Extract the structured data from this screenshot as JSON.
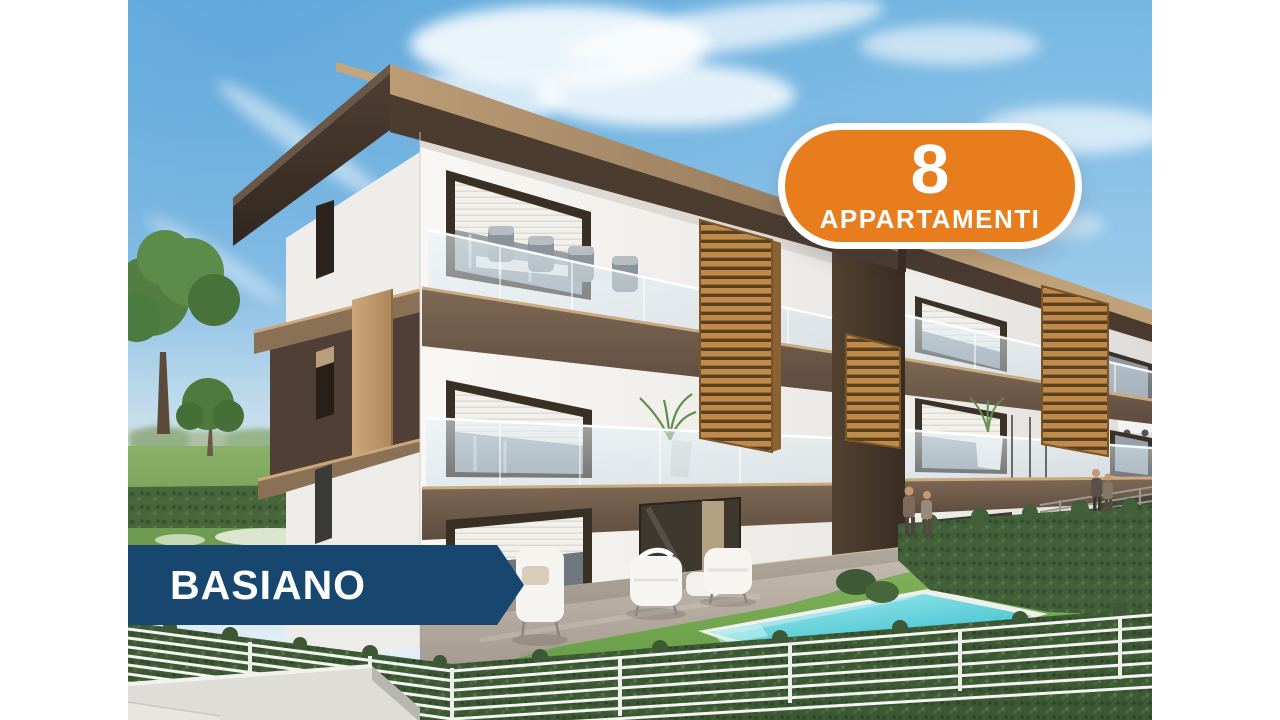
{
  "page": {
    "background_color": "#FFFFFF"
  },
  "badge": {
    "count": "8",
    "label": "APPARTAMENTI",
    "background_color": "#E87D1E",
    "border_color": "#FFFFFF",
    "text_color": "#FFFFFF"
  },
  "location_banner": {
    "label": "BASIANO",
    "background_color": "#17466F",
    "text_color": "#FFFFFF"
  },
  "photo": {
    "description": "3D architectural rendering of a modern three-storey apartment complex with white and brown facades, wooden louver panels, glass balconies with outdoor furniture, a turquoise swimming pool in a green garden, hedges, a white horizontal-bar fence, lawn chairs on a patio, trees and a blue sky with wispy clouds",
    "accent_colors": {
      "sky_blue": "#76B7E2",
      "facade_brown": "#4C3C30",
      "wood_louver": "#BE8B4B",
      "pool_water": "#2CB9CB",
      "lawn_green": "#6FA14E"
    }
  }
}
